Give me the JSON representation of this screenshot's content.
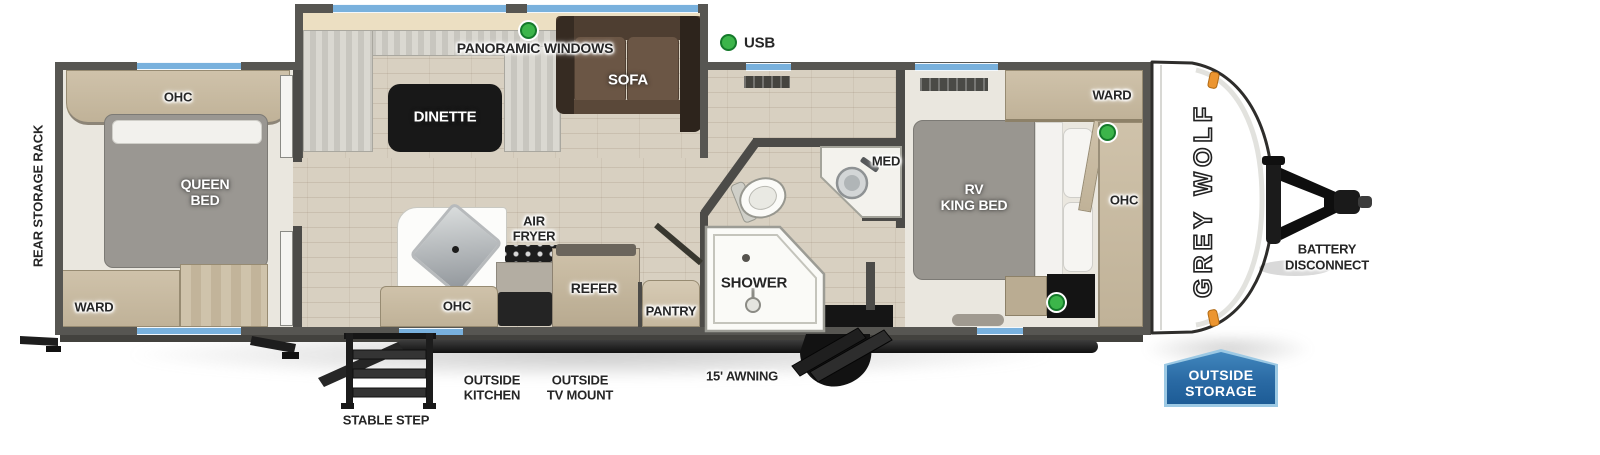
{
  "floor_plan": {
    "brand": "GREY WOLF",
    "exterior": {
      "rear_storage_rack": "REAR STORAGE RACK",
      "battery_line1": "BATTERY",
      "battery_line2": "DISCONNECT",
      "badge_line1": "OUTSIDE",
      "badge_line2": "STORAGE",
      "outside_kitchen_line1": "OUTSIDE",
      "outside_kitchen_line2": "KITCHEN",
      "outside_tv_line1": "OUTSIDE",
      "outside_tv_line2": "TV MOUNT",
      "awning": "15' AWNING",
      "stable_step": "STABLE STEP"
    },
    "interior": {
      "panoramic_windows": "PANORAMIC WINDOWS",
      "usb": "USB",
      "rear_bedroom": {
        "ohc": "OHC",
        "queen_line1": "QUEEN",
        "queen_line2": "BED",
        "ward": "WARD"
      },
      "living": {
        "dinette": "DINETTE",
        "sofa": "SOFA"
      },
      "kitchen": {
        "air_fryer_line1": "AIR",
        "air_fryer_line2": "FRYER",
        "ohc": "OHC",
        "refer": "REFER",
        "pantry": "PANTRY"
      },
      "bathroom": {
        "shower": "SHOWER",
        "med": "MED"
      },
      "front_bedroom": {
        "king_line1": "RV",
        "king_line2": "KING BED",
        "ward": "WARD",
        "ohc": "OHC"
      }
    },
    "colors": {
      "wall": "#575652",
      "window_glass": "#79b1dd",
      "usb_indicator": "#3cb54a",
      "badge_blue": "#2a6aa4",
      "marker_light": "#ec9530"
    }
  }
}
